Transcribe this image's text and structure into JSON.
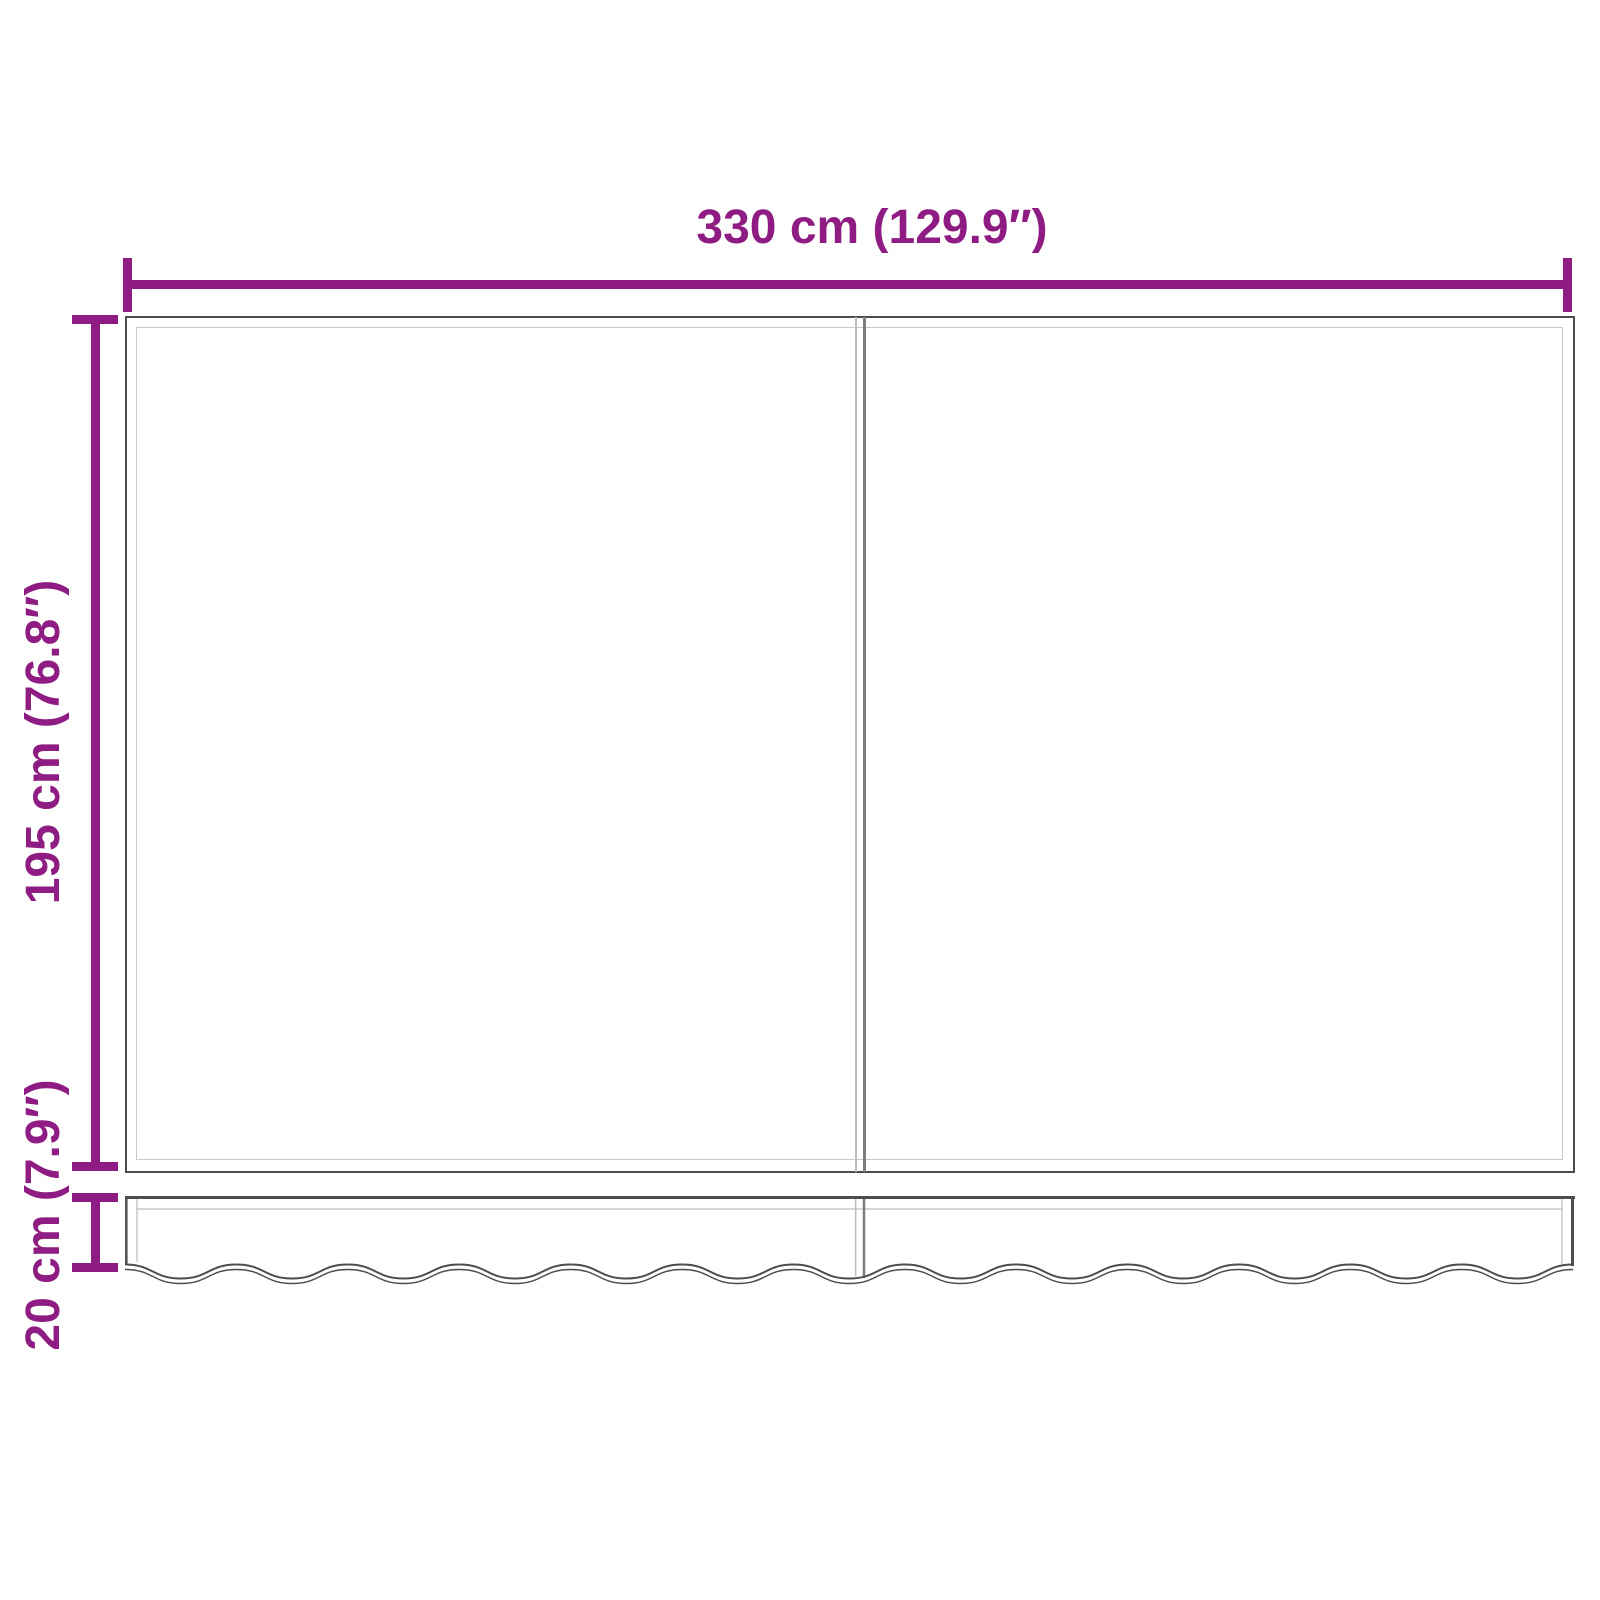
{
  "diagram": {
    "title": "awning-fabric-dimension-diagram",
    "width_dimension": {
      "label": "330 cm (129.9″)",
      "value_cm": 330,
      "value_inch": 129.9
    },
    "height_dimension": {
      "label": "195 cm (76.8″)",
      "value_cm": 195,
      "value_inch": 76.8
    },
    "valance_dimension": {
      "label": "20 cm (7.9″)",
      "value_cm": 20,
      "value_inch": 7.9
    },
    "colors": {
      "dimension": "#8E1C82",
      "outline": "#4d4d4d",
      "hem": "#c9c9c9",
      "seam_dark": "#7d7d7d",
      "seam_light": "#bdbdbd",
      "background": "#ffffff"
    }
  }
}
